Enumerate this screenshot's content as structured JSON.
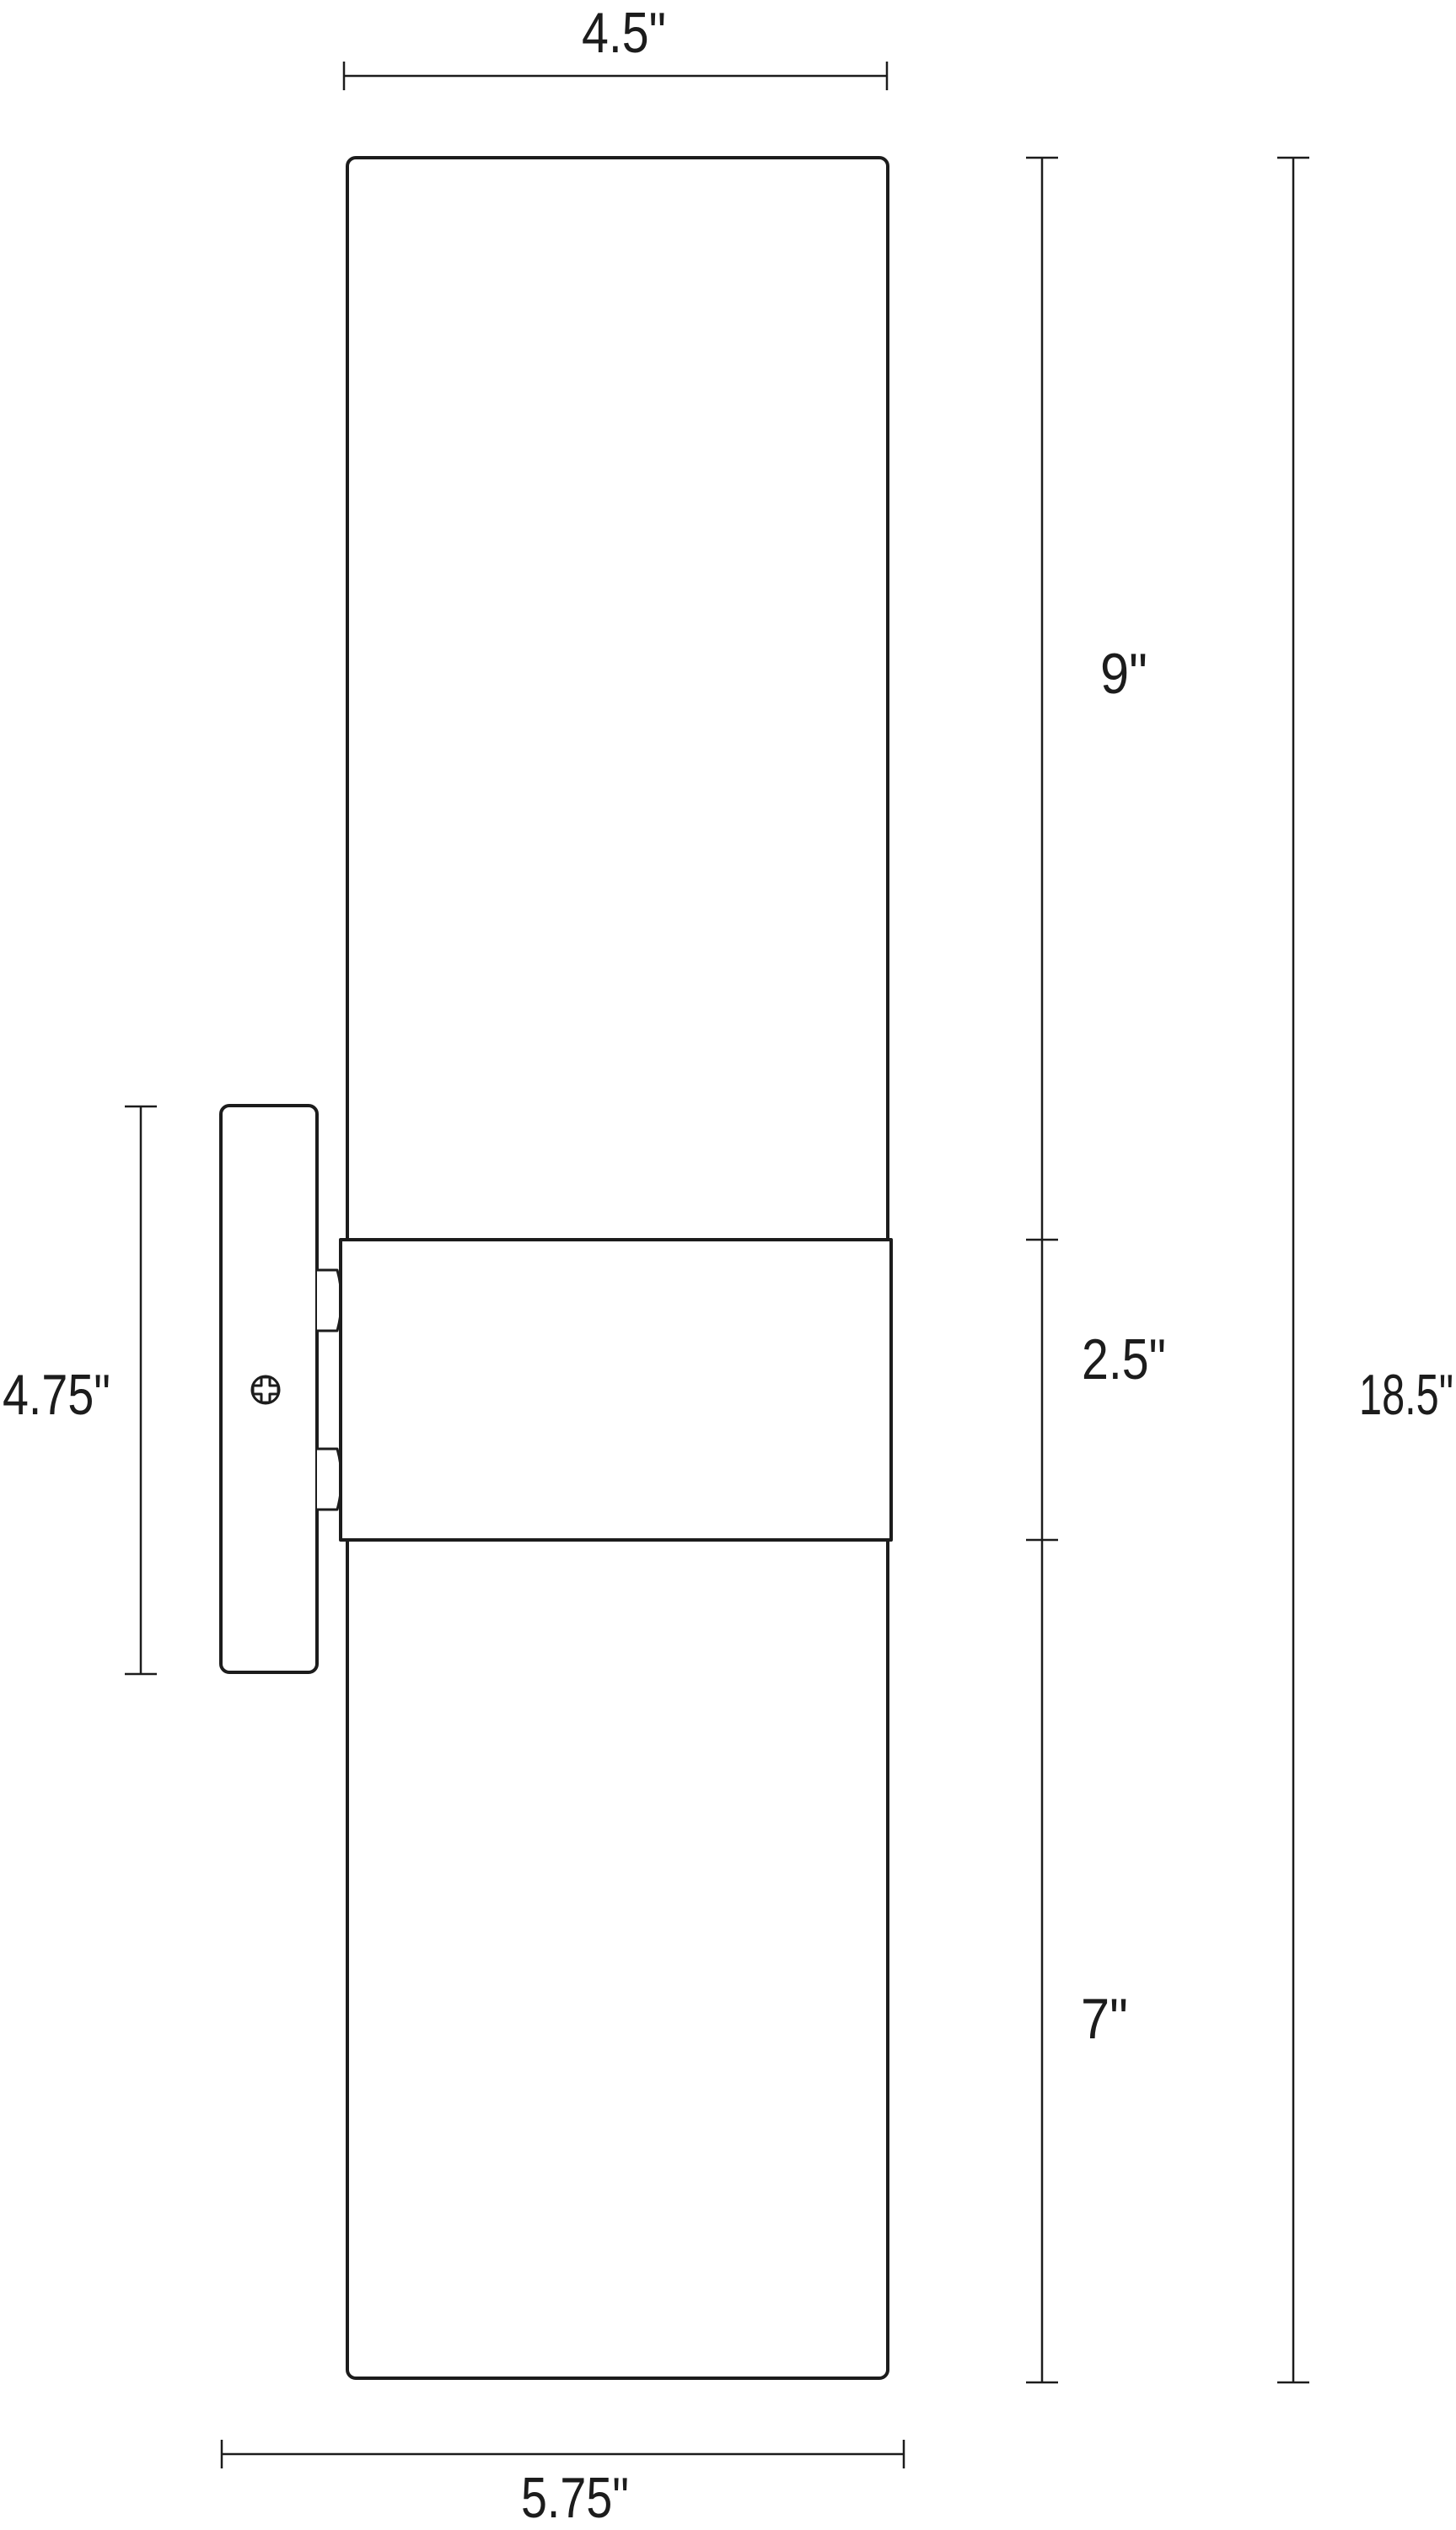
{
  "page": {
    "background_color": "#ffffff",
    "line_color": "#1c1c1c"
  },
  "drawing": {
    "type": "technical-dimension-drawing",
    "subject": "cylindrical wall sconce, side elevation with mounting backplate",
    "icons": {
      "screw": "phillips-screw"
    },
    "labels": {
      "shade_width": "4.5\"",
      "upper_shade_height": "9\"",
      "band_height": "2.5\"",
      "overall_height": "18.5\"",
      "backplate_height": "4.75\"",
      "lower_shade_height": "7\"",
      "overall_depth": "5.75\""
    }
  }
}
